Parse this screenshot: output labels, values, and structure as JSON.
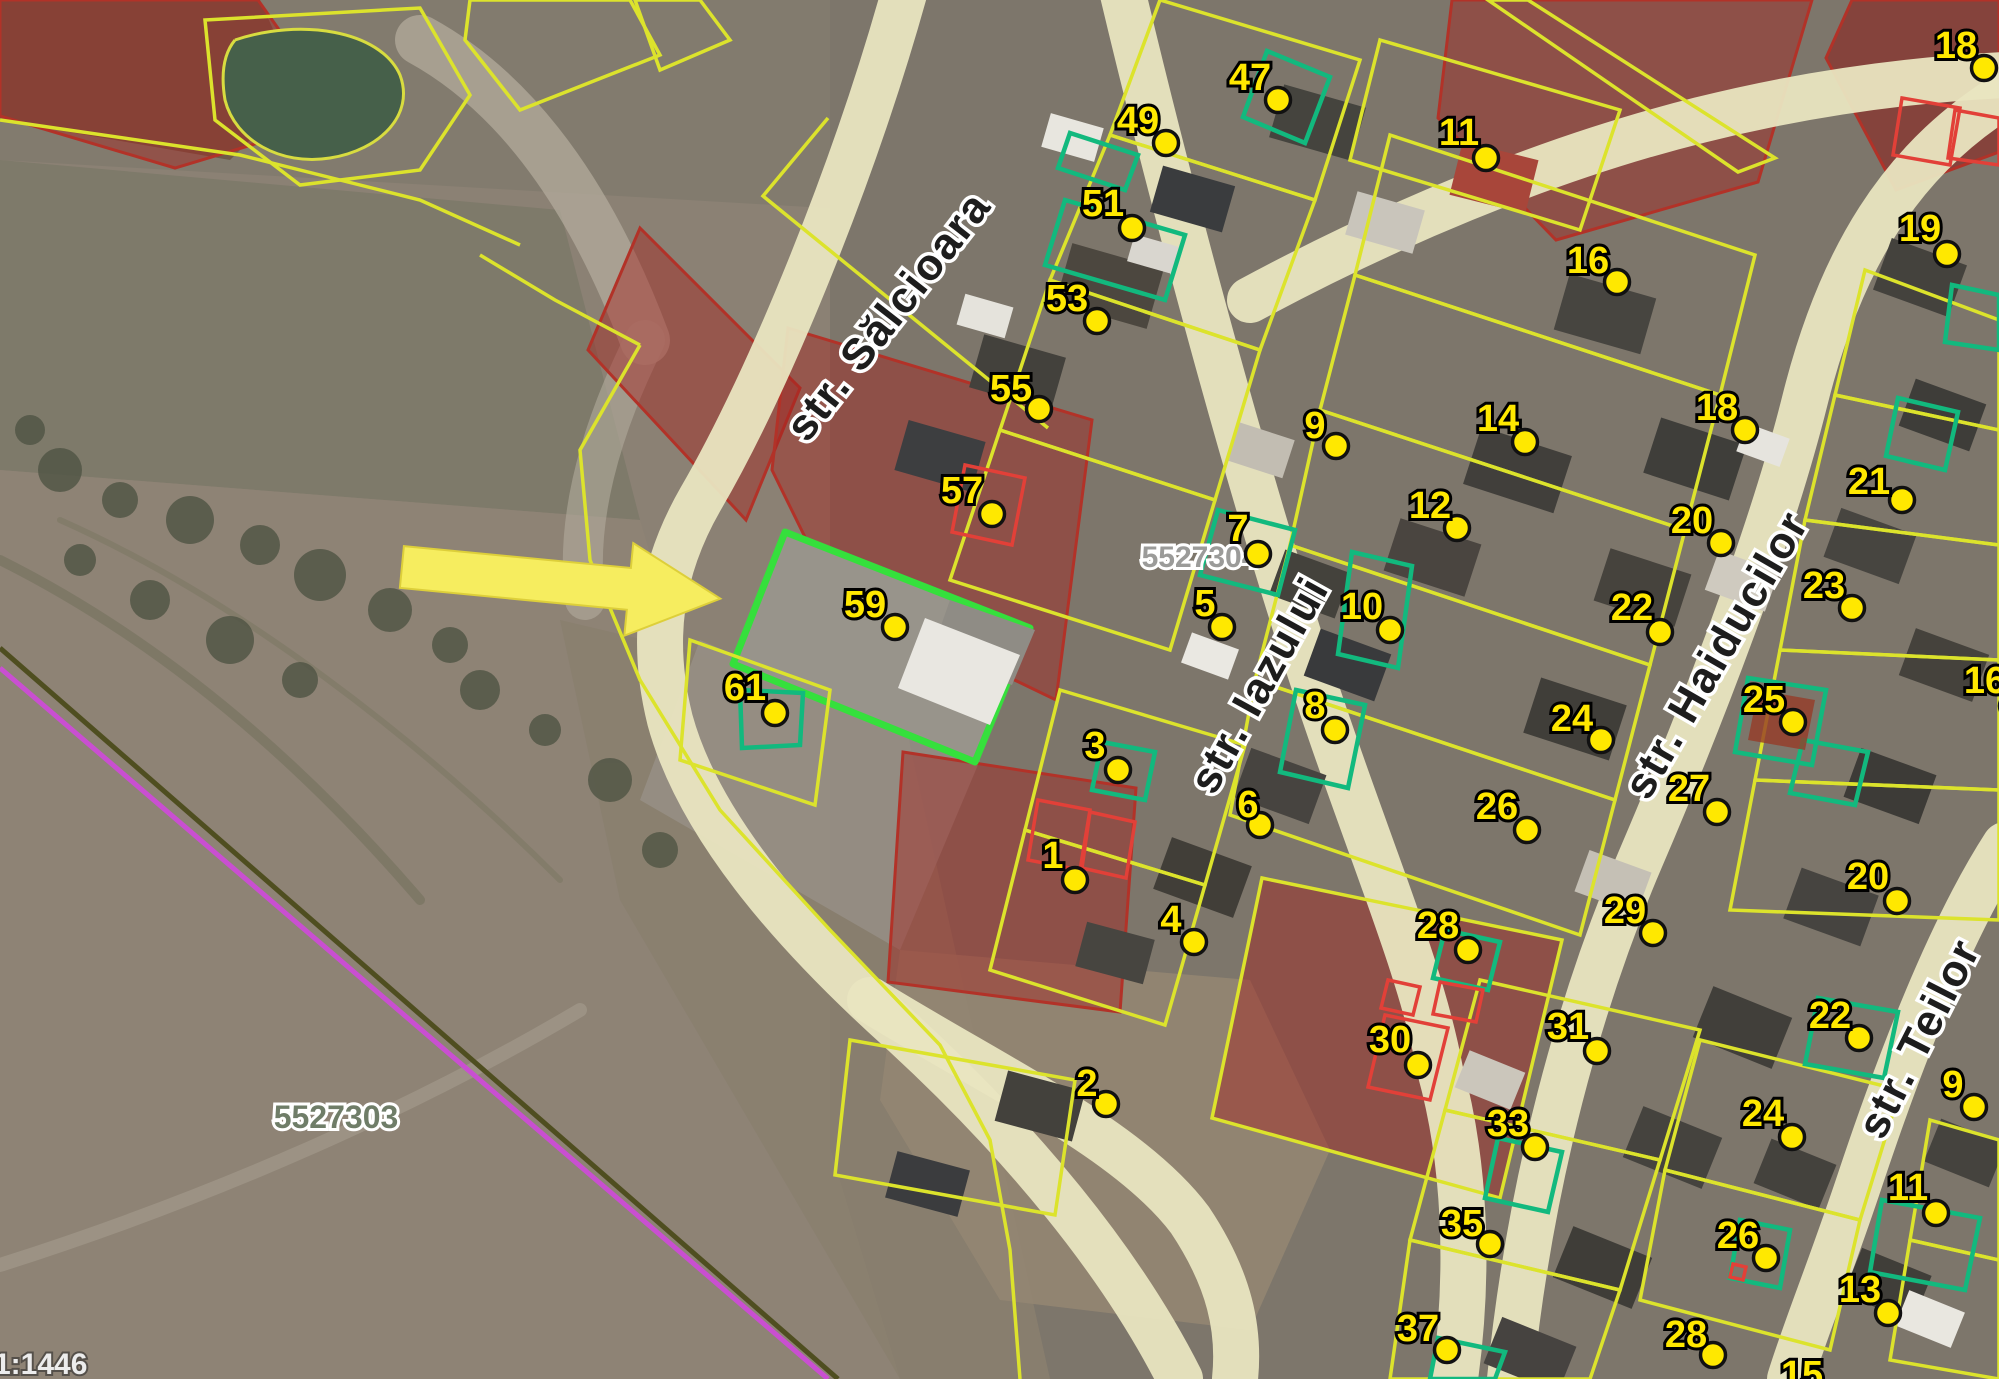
{
  "map": {
    "scale_label": "1:1446",
    "zone_codes": [
      {
        "id": "zone-5527304",
        "text": "5527304",
        "x": 1200,
        "y": 567,
        "size": 30,
        "color": "#9b9b99"
      },
      {
        "id": "zone-5527303",
        "text": "5527303",
        "x": 336,
        "y": 1128,
        "size": 32,
        "color": "#6f7d68"
      }
    ],
    "streets": [
      {
        "id": "salcioara",
        "name": "str. Sălcioara",
        "x": 900,
        "y": 325,
        "rot": -52
      },
      {
        "id": "iazului",
        "name": "str. Iazului",
        "x": 1272,
        "y": 692,
        "rot": -61
      },
      {
        "id": "haiducilor",
        "name": "str. Haiducilor",
        "x": 1729,
        "y": 662,
        "rot": -60
      },
      {
        "id": "teilor",
        "name": "str. Teilor",
        "x": 1932,
        "y": 1045,
        "rot": -63
      }
    ],
    "colors": {
      "marker_yellow": "#ffe800",
      "marker_ring": "#111111",
      "parcel_yellow": "#dce32c",
      "building_green": "#12b97e",
      "building_red": "#e24038",
      "highlight_green": "#35e03c",
      "red_zone_fill": "rgba(165,35,30,0.45)",
      "road_beige": "#e9e5c0",
      "arrow_yellow": "#f6ed5f"
    },
    "markers": [
      {
        "label": "47",
        "x": 1250,
        "y": 77,
        "dx": 1278,
        "dy": 100
      },
      {
        "label": "49",
        "x": 1138,
        "y": 120,
        "dx": 1166,
        "dy": 143
      },
      {
        "label": "51",
        "x": 1103,
        "y": 203,
        "dx": 1132,
        "dy": 228
      },
      {
        "label": "53",
        "x": 1067,
        "y": 298,
        "dx": 1097,
        "dy": 321
      },
      {
        "label": "55",
        "x": 1011,
        "y": 388,
        "dx": 1039,
        "dy": 409
      },
      {
        "label": "57",
        "x": 962,
        "y": 490,
        "dx": 992,
        "dy": 514
      },
      {
        "label": "59",
        "x": 865,
        "y": 604,
        "dx": 895,
        "dy": 627
      },
      {
        "label": "61",
        "x": 745,
        "y": 687,
        "dx": 775,
        "dy": 713
      },
      {
        "label": "11",
        "x": 1459,
        "y": 132,
        "dx": 1486,
        "dy": 158
      },
      {
        "label": "16",
        "x": 1588,
        "y": 260,
        "dx": 1617,
        "dy": 282
      },
      {
        "label": "9",
        "x": 1315,
        "y": 425,
        "dx": 1336,
        "dy": 446
      },
      {
        "label": "14",
        "x": 1498,
        "y": 418,
        "dx": 1525,
        "dy": 442
      },
      {
        "label": "12",
        "x": 1430,
        "y": 505,
        "dx": 1457,
        "dy": 528
      },
      {
        "label": "18",
        "x": 1717,
        "y": 407,
        "dx": 1745,
        "dy": 430
      },
      {
        "label": "7",
        "x": 1238,
        "y": 528,
        "dx": 1258,
        "dy": 554
      },
      {
        "label": "5",
        "x": 1205,
        "y": 603,
        "dx": 1222,
        "dy": 627
      },
      {
        "label": "10",
        "x": 1362,
        "y": 606,
        "dx": 1390,
        "dy": 630
      },
      {
        "label": "8",
        "x": 1315,
        "y": 705,
        "dx": 1335,
        "dy": 730
      },
      {
        "label": "6",
        "x": 1248,
        "y": 804,
        "dx": 1260,
        "dy": 825
      },
      {
        "label": "3",
        "x": 1095,
        "y": 745,
        "dx": 1118,
        "dy": 770
      },
      {
        "label": "1",
        "x": 1053,
        "y": 855,
        "dx": 1075,
        "dy": 880
      },
      {
        "label": "4",
        "x": 1171,
        "y": 919,
        "dx": 1194,
        "dy": 942
      },
      {
        "label": "2",
        "x": 1087,
        "y": 1083,
        "dx": 1106,
        "dy": 1104
      },
      {
        "label": "22",
        "x": 1632,
        "y": 607,
        "dx": 1660,
        "dy": 632
      },
      {
        "label": "20",
        "x": 1692,
        "y": 520,
        "dx": 1721,
        "dy": 543
      },
      {
        "label": "23",
        "x": 1824,
        "y": 585,
        "dx": 1852,
        "dy": 608
      },
      {
        "label": "25",
        "x": 1764,
        "y": 699,
        "dx": 1793,
        "dy": 722
      },
      {
        "label": "27",
        "x": 1689,
        "y": 788,
        "dx": 1717,
        "dy": 812
      },
      {
        "label": "24",
        "x": 1572,
        "y": 718,
        "dx": 1601,
        "dy": 740
      },
      {
        "label": "26",
        "x": 1497,
        "y": 806,
        "dx": 1527,
        "dy": 830
      },
      {
        "label": "29",
        "x": 1625,
        "y": 910,
        "dx": 1653,
        "dy": 933
      },
      {
        "label": "20",
        "x": 1868,
        "y": 876,
        "dx": 1897,
        "dy": 901
      },
      {
        "label": "16",
        "x": 1985,
        "y": 680,
        "dx": 2012,
        "dy": 706
      },
      {
        "label": "19",
        "x": 1920,
        "y": 228,
        "dx": 1947,
        "dy": 254
      },
      {
        "label": "18",
        "x": 1956,
        "y": 45,
        "dx": 1984,
        "dy": 68
      },
      {
        "label": "21",
        "x": 1869,
        "y": 481,
        "dx": 1902,
        "dy": 500
      },
      {
        "label": "28",
        "x": 1438,
        "y": 925,
        "dx": 1468,
        "dy": 950
      },
      {
        "label": "31",
        "x": 1568,
        "y": 1026,
        "dx": 1597,
        "dy": 1051
      },
      {
        "label": "30",
        "x": 1390,
        "y": 1039,
        "dx": 1418,
        "dy": 1065
      },
      {
        "label": "33",
        "x": 1508,
        "y": 1123,
        "dx": 1535,
        "dy": 1147
      },
      {
        "label": "35",
        "x": 1462,
        "y": 1223,
        "dx": 1490,
        "dy": 1244
      },
      {
        "label": "37",
        "x": 1418,
        "y": 1328,
        "dx": 1447,
        "dy": 1350
      },
      {
        "label": "28",
        "x": 1686,
        "y": 1334,
        "dx": 1713,
        "dy": 1355
      },
      {
        "label": "22",
        "x": 1830,
        "y": 1015,
        "dx": 1859,
        "dy": 1038
      },
      {
        "label": "9",
        "x": 1953,
        "y": 1084,
        "dx": 1974,
        "dy": 1107
      },
      {
        "label": "11",
        "x": 1908,
        "y": 1187,
        "dx": 1936,
        "dy": 1213
      },
      {
        "label": "24",
        "x": 1763,
        "y": 1113,
        "dx": 1792,
        "dy": 1137
      },
      {
        "label": "26",
        "x": 1738,
        "y": 1235,
        "dx": 1766,
        "dy": 1258
      },
      {
        "label": "13",
        "x": 1860,
        "y": 1289,
        "dx": 1888,
        "dy": 1313
      },
      {
        "label": "15",
        "x": 1802,
        "y": 1374,
        "dx": 1820,
        "dy": 1396
      }
    ]
  }
}
